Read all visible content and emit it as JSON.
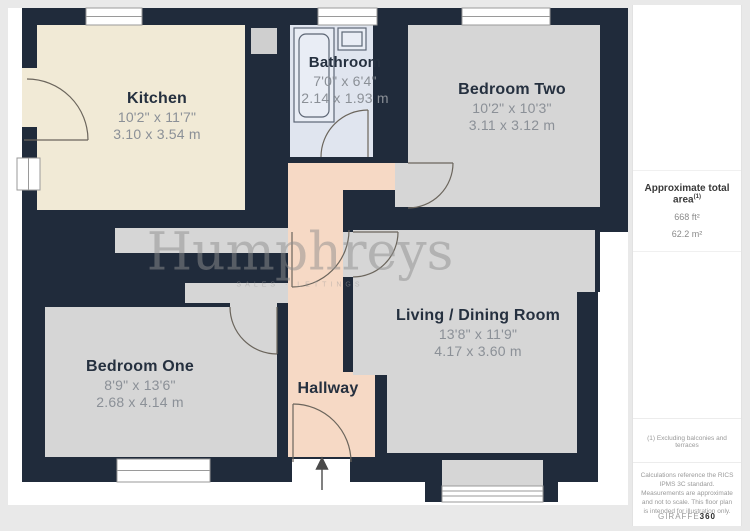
{
  "floor_plan": {
    "rooms": {
      "kitchen": {
        "name": "Kitchen",
        "dims_imperial": "10'2\" x 11'7\"",
        "dims_metric": "3.10 x 3.54 m"
      },
      "bathroom": {
        "name": "Bathroom",
        "dims_imperial": "7'0\" x 6'4\"",
        "dims_metric": "2.14 x 1.93 m"
      },
      "bedroom_two": {
        "name": "Bedroom Two",
        "dims_imperial": "10'2\" x 10'3\"",
        "dims_metric": "3.11 x 3.12 m"
      },
      "bedroom_one": {
        "name": "Bedroom One",
        "dims_imperial": "8'9\" x 13'6\"",
        "dims_metric": "2.68 x 4.14 m"
      },
      "living_dining": {
        "name": "Living / Dining Room",
        "dims_imperial": "13'8\" x 11'9\"",
        "dims_metric": "4.17 x 3.60 m"
      },
      "hallway": {
        "name": "Hallway"
      }
    },
    "watermark": {
      "name": "Humphreys",
      "tagline": "SALES · LETTINGS"
    }
  },
  "sidebar": {
    "area_title": "Approximate total area",
    "area_title_sup": "(1)",
    "area_ft": "668 ft²",
    "area_m": "62.2 m²",
    "footnote_1": "(1) Excluding balconies and terraces",
    "disclaimer": "Calculations reference the RICS IPMS 3C standard. Measurements are approximate and not to scale. This floor plan is intended for illustration only.",
    "brand_light": "GIRAFFE",
    "brand_bold": "360"
  },
  "colors": {
    "wall": "#202b3b",
    "kitchen_floor": "#f1ead6",
    "bathroom_floor": "#e0e5ef",
    "bedroom_floor": "#d6d6d6",
    "hallway_floor": "#f6d9c5",
    "page": "#ffffff",
    "background": "#e9e9e9"
  }
}
